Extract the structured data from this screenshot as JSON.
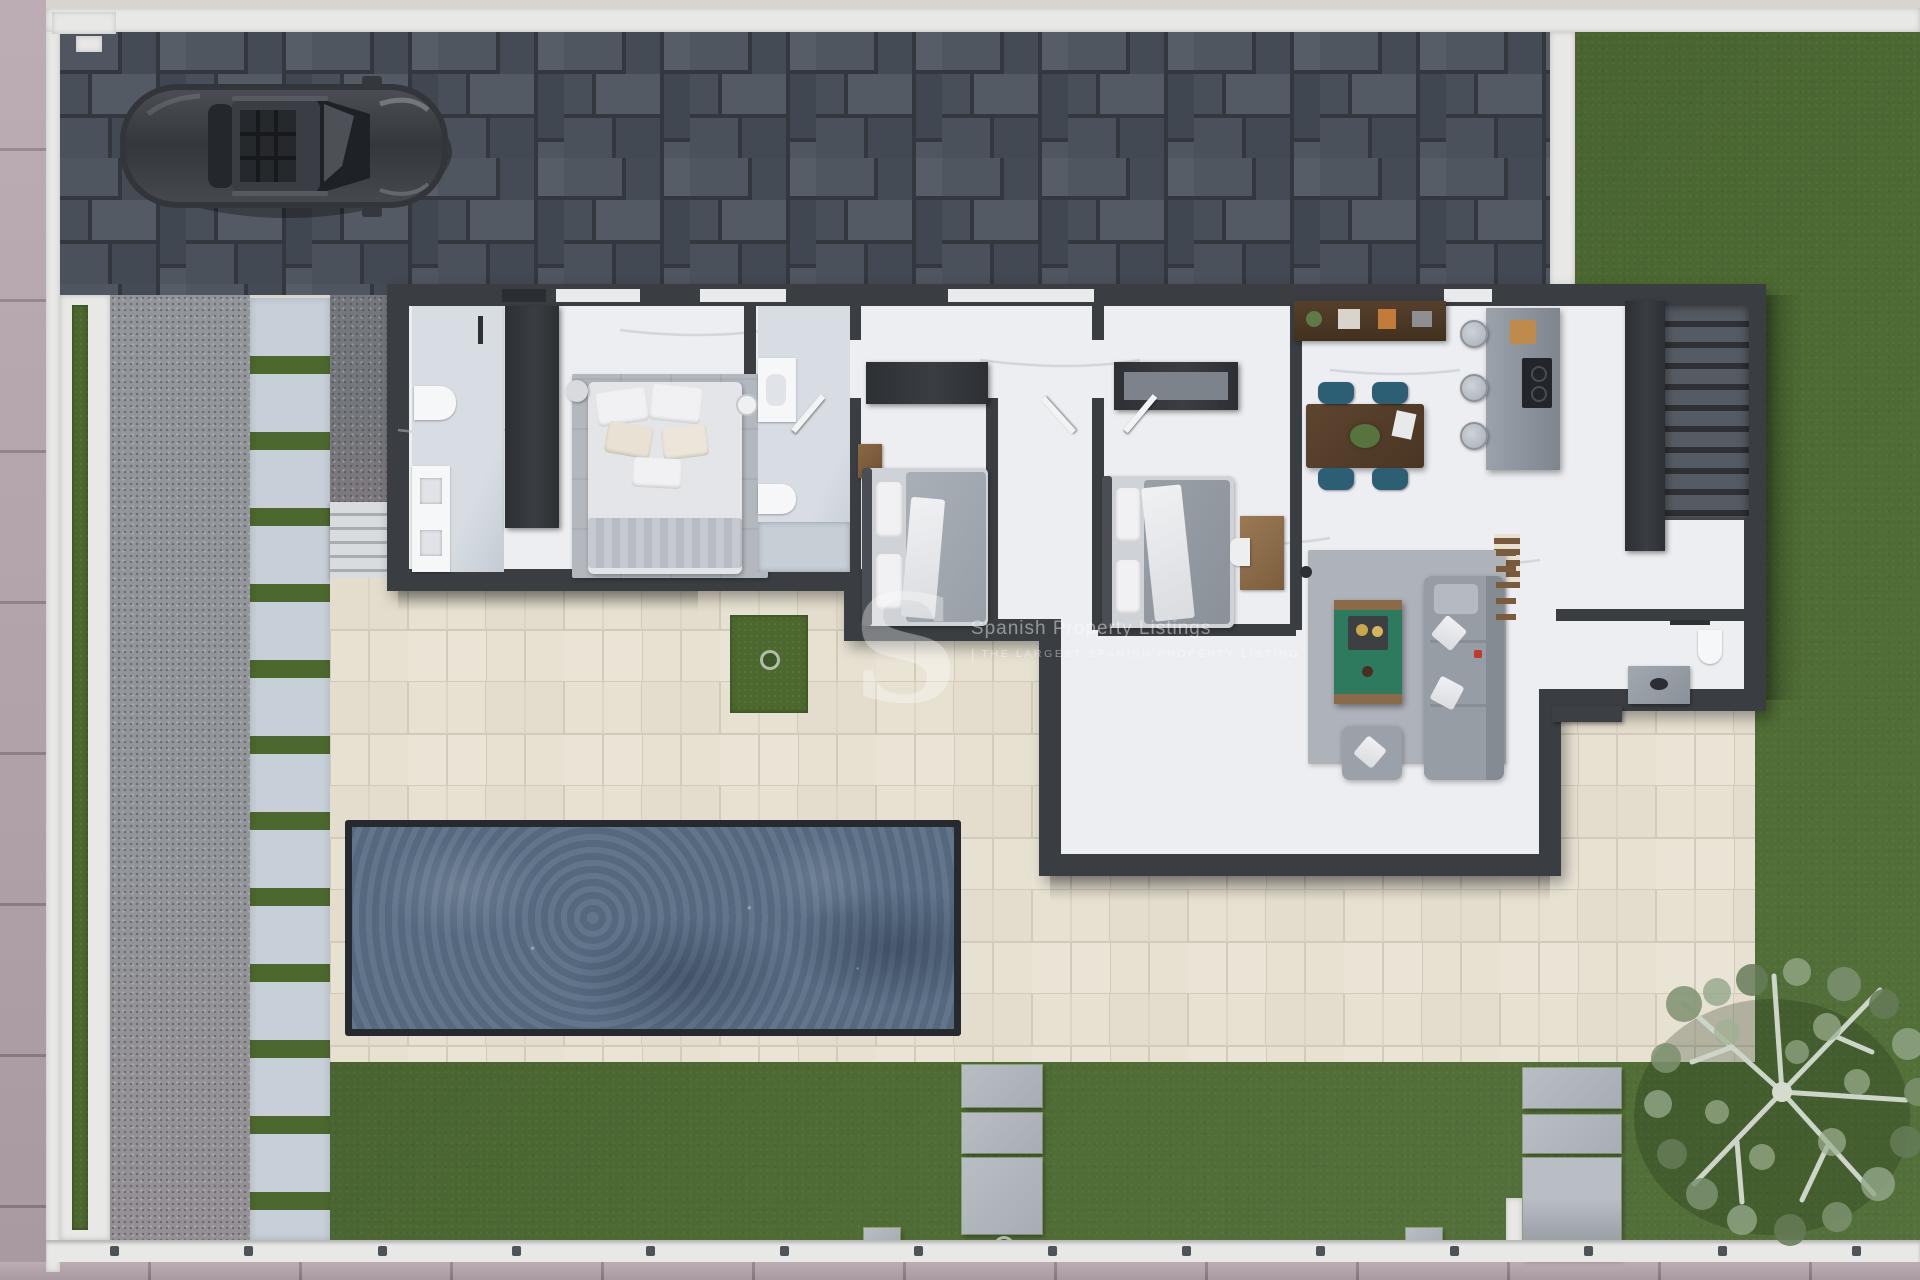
{
  "scene": {
    "kind": "top-down 3D architectural render",
    "subject": "single-storey villa plot with driveway, car, pool, terrace and gardens"
  },
  "watermark": {
    "logo_letter": "S",
    "brand": "Spanish Property Listings",
    "separator": "|",
    "tagline": "THE LARGEST SPANISH PROPERTY LISTING"
  },
  "palette": {
    "lawn": "#4e6b33",
    "grass_strip": "#4c682e",
    "terrace": "#e6e0d1",
    "terrace_joint": "#d2cbb9",
    "pool_water": "#5a6e85",
    "pool_rim": "#262a2f",
    "house_wall": "#3a3e42",
    "interior_floor": "#eceef1",
    "bath_floor": "#d7dde3",
    "sidewalk": "#b3a2aa",
    "boundary_wall": "#e8e9e7",
    "gravel": "#92959a",
    "step_slab": "#c7cfd8",
    "driveway_paver": "#454c55",
    "paver_gap": "#2d3238",
    "car_body": "#34373c",
    "wood_dark": "#553f2b",
    "chair_teal": "#2c5f74",
    "coffee_table_green": "#2e7a5f",
    "sofa_gray": "#969da5"
  },
  "objects": {
    "vehicle": "parked car on block-paved driveway",
    "rooms": [
      "bathroom-1",
      "master-bedroom",
      "bathroom-2",
      "bedroom-2",
      "bedroom-3",
      "kitchen-dining",
      "living-room",
      "bathroom-3",
      "staircase"
    ],
    "garden": [
      "pool",
      "terrace",
      "stepping-stones",
      "olive-tree",
      "grass-strips"
    ]
  }
}
